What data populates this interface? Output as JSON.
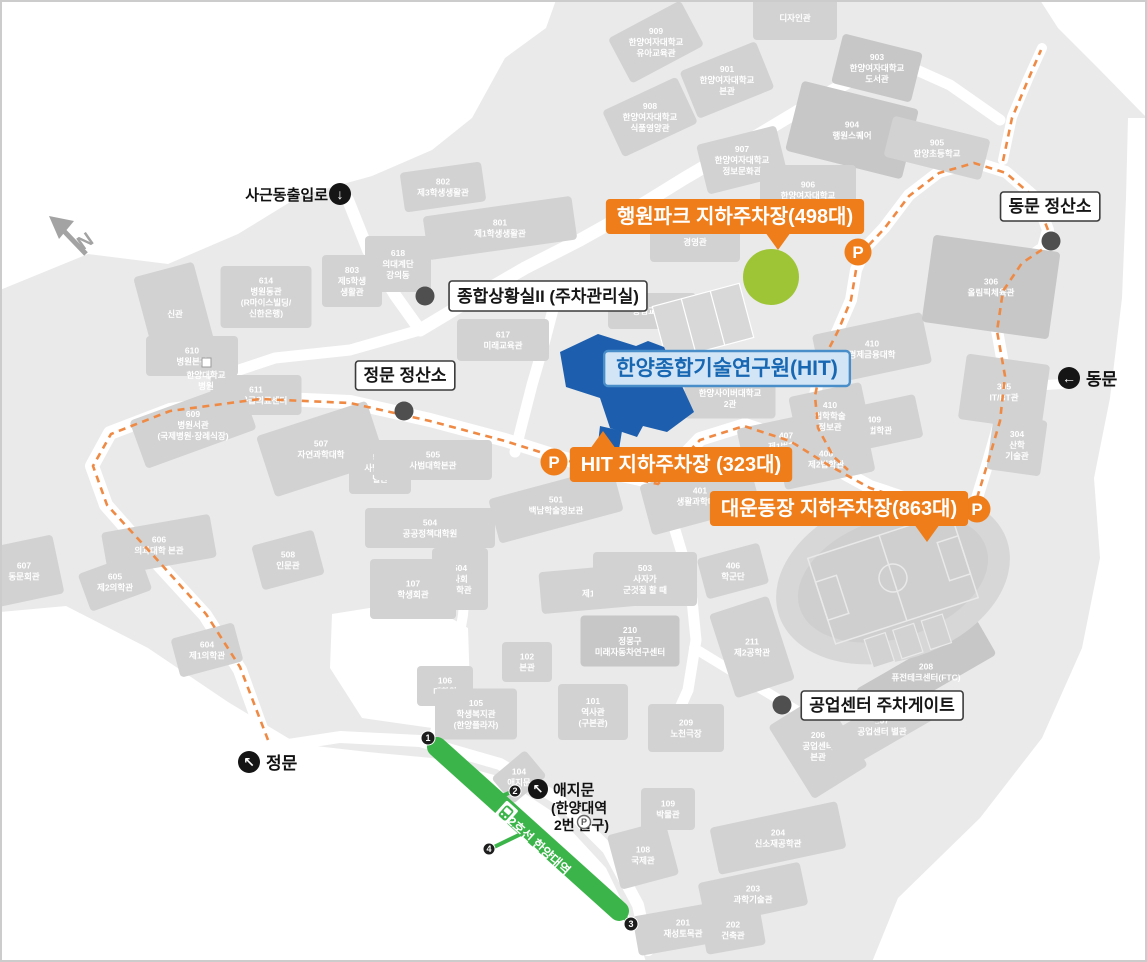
{
  "colors": {
    "accent_orange": "#ef7d1a",
    "route_orange": "#ef8a45",
    "hit_blue": "#1d5fae",
    "hit_label_bg": "#d2e5f6",
    "hit_label_border": "#4a8ec9",
    "hit_label_text": "#1767b3",
    "subway_green": "#3bb54a",
    "park_green": "#9ec535",
    "dot_gray": "#4f4f4f",
    "building_gray": "#d2d2d2",
    "terrain_gray": "#eaeaea"
  },
  "compass_label": "N",
  "p_letter": "P",
  "parking_callouts": [
    {
      "label": "행원파크 지하주차장(498대)",
      "cx": 735,
      "cy": 216,
      "tail": "down",
      "tail_x": 778
    },
    {
      "label": "HIT 지하주차장 (323대)",
      "cx": 681,
      "cy": 464,
      "tail": "up",
      "tail_x": 603
    },
    {
      "label": "대운동장 지하주차장(863대)",
      "cx": 839,
      "cy": 508,
      "tail": "down",
      "tail_x": 927
    }
  ],
  "p_markers": [
    {
      "x": 858,
      "y": 252
    },
    {
      "x": 554,
      "y": 462
    },
    {
      "x": 977,
      "y": 509
    }
  ],
  "info_callouts": [
    {
      "label": "동문 정산소",
      "cx": 1050,
      "cy": 206,
      "dot_x": 1051,
      "dot_y": 241
    },
    {
      "label": "정문 정산소",
      "cx": 405,
      "cy": 375,
      "dot_x": 404,
      "dot_y": 411
    },
    {
      "label": "종합상황실II (주차관리실)",
      "cx": 548,
      "cy": 296,
      "dot_x": 425,
      "dot_y": 296
    },
    {
      "label": "공업센터 주차게이트",
      "cx": 882,
      "cy": 705,
      "dot_x": 782,
      "dot_y": 705
    }
  ],
  "hit_callout": {
    "label": "한양종합기술연구원(HIT)",
    "cx": 727,
    "cy": 368
  },
  "gates": [
    {
      "label": "사근동출입로",
      "arrow": "↓",
      "icon_x": 340,
      "icon_y": 194,
      "text_x": 328,
      "text_y": 200,
      "anchor": "end",
      "size": 15
    },
    {
      "label": "동문",
      "arrow": "←",
      "icon_x": 1069,
      "icon_y": 378,
      "text_x": 1086,
      "text_y": 385,
      "anchor": "start",
      "size": 17
    },
    {
      "label": "정문",
      "arrow": "↖",
      "icon_x": 249,
      "icon_y": 762,
      "text_x": 266,
      "text_y": 769,
      "anchor": "start",
      "size": 17
    }
  ],
  "ajimun": {
    "label": "애지문",
    "sub1": "(한양대역",
    "sub2": "2번 출구)",
    "arrow": "↖",
    "icon_x": 538,
    "icon_y": 789,
    "p_x": 584,
    "p_y": 822
  },
  "subway": {
    "line_label": "2호선 한양대역",
    "exits": [
      {
        "n": "1",
        "x": 428,
        "y": 738
      },
      {
        "n": "2",
        "x": 515,
        "y": 791
      },
      {
        "n": "3",
        "x": 631,
        "y": 924
      },
      {
        "n": "4",
        "x": 489,
        "y": 849
      }
    ]
  },
  "stadium": {
    "num": "301",
    "name": "대운동장",
    "x": 893,
    "y": 568
  },
  "hwangwon": {
    "num": "707",
    "name": "행원파크",
    "x": 771,
    "y": 276
  },
  "tennis": {
    "name": "테니스장",
    "x": 710,
    "y": 337
  },
  "hospital_sub": {
    "line1": "한양대학교",
    "line2": "병원",
    "x": 206,
    "y": 384
  },
  "buildings": [
    {
      "l": [
        "909",
        "한양여자대학교",
        "유아교육관"
      ],
      "x": 656,
      "y": 42,
      "r": -28
    },
    {
      "l": [
        "901",
        "한양여자대학교",
        "본관"
      ],
      "x": 727,
      "y": 80,
      "r": -22
    },
    {
      "l": [
        "903",
        "한양여자대학교",
        "도서관"
      ],
      "x": 877,
      "y": 68,
      "r": 14,
      "f": 1
    },
    {
      "l": [
        "908",
        "한양여자대학교",
        "식품영양관"
      ],
      "x": 650,
      "y": 117,
      "r": -25
    },
    {
      "l": [
        "904",
        "행원스퀘어"
      ],
      "x": 852,
      "y": 130,
      "r": 14,
      "w": 120,
      "h": 72,
      "f": 1
    },
    {
      "l": [
        "907",
        "한양여자대학교",
        "정보문화관"
      ],
      "x": 742,
      "y": 160,
      "r": -14
    },
    {
      "l": [
        "905",
        "한양초등학교"
      ],
      "x": 937,
      "y": 148,
      "r": 14,
      "w": 100,
      "h": 42
    },
    {
      "l": [
        "906",
        "한양여자대학교"
      ],
      "x": 808,
      "y": 190,
      "r": 0,
      "w": 96,
      "h": 50
    },
    {
      "l": [
        "디자인관"
      ],
      "x": 795,
      "y": 18,
      "r": 0,
      "w": 84,
      "h": 44
    },
    {
      "l": [
        "802",
        "제3학생생활관"
      ],
      "x": 443,
      "y": 187,
      "r": -8
    },
    {
      "l": [
        "801",
        "제1학생생활관"
      ],
      "x": 500,
      "y": 228,
      "r": -8,
      "w": 150,
      "h": 44
    },
    {
      "l": [
        "618",
        "의대계단",
        "강의동"
      ],
      "x": 398,
      "y": 264,
      "r": 0,
      "w": 66,
      "h": 56
    },
    {
      "l": [
        "803",
        "제5학생",
        "생활관"
      ],
      "x": 352,
      "y": 281,
      "r": 0,
      "w": 60,
      "h": 52
    },
    {
      "l": [
        "614",
        "병원동관",
        "(R마이스빌딩/",
        "신한은행)"
      ],
      "x": 266,
      "y": 297,
      "r": 0
    },
    {
      "l": [
        "신관"
      ],
      "x": 175,
      "y": 314,
      "r": -15,
      "w": 62,
      "h": 92
    },
    {
      "l": [
        "610",
        "병원본관"
      ],
      "x": 192,
      "y": 356,
      "r": 0,
      "w": 92,
      "h": 40
    },
    {
      "l": [
        "611",
        "권역응급의료센터"
      ],
      "x": 256,
      "y": 395,
      "r": 0
    },
    {
      "l": [
        "609",
        "병원서관",
        "(국제병원·장례식장)"
      ],
      "x": 193,
      "y": 425,
      "r": -20
    },
    {
      "l": [
        "607",
        "동문회관"
      ],
      "x": 24,
      "y": 571,
      "r": -12,
      "w": 70,
      "h": 60
    },
    {
      "l": [
        "606",
        "의과대학 본관"
      ],
      "x": 159,
      "y": 545,
      "r": -10,
      "w": 110,
      "h": 44
    },
    {
      "l": [
        "605",
        "제2의학관"
      ],
      "x": 115,
      "y": 582,
      "r": -20
    },
    {
      "l": [
        "604",
        "제1의학관"
      ],
      "x": 207,
      "y": 650,
      "r": -15
    },
    {
      "l": [
        "508",
        "인문관"
      ],
      "x": 288,
      "y": 560,
      "r": -15,
      "w": 64,
      "h": 46
    },
    {
      "l": [
        "507",
        "자연과학대학"
      ],
      "x": 321,
      "y": 449,
      "r": -18,
      "w": 116,
      "h": 64
    },
    {
      "l": [
        "506",
        "사범대학",
        "별관"
      ],
      "x": 380,
      "y": 468,
      "r": 0,
      "w": 62,
      "h": 52
    },
    {
      "l": [
        "505",
        "사범대학본관"
      ],
      "x": 433,
      "y": 460,
      "r": 0,
      "w": 118,
      "h": 40
    },
    {
      "l": [
        "501",
        "백남학술정보관"
      ],
      "x": 556,
      "y": 505,
      "r": -15,
      "w": 128,
      "h": 46
    },
    {
      "l": [
        "504",
        "공공정책대학원"
      ],
      "x": 430,
      "y": 528,
      "r": 0,
      "w": 130,
      "h": 40
    },
    {
      "l": [
        "504",
        "사회",
        "과학관"
      ],
      "x": 460,
      "y": 579,
      "r": 0,
      "w": 56,
      "h": 62
    },
    {
      "l": [
        "107",
        "학생회관"
      ],
      "x": 413,
      "y": 589,
      "r": 0,
      "w": 86,
      "h": 60
    },
    {
      "l": [
        "212",
        "제1공학관"
      ],
      "x": 600,
      "y": 588,
      "r": -5,
      "w": 120,
      "h": 42
    },
    {
      "l": [
        "503",
        "사자가",
        "군것질 할 때"
      ],
      "x": 645,
      "y": 579,
      "r": 0,
      "w": 104,
      "h": 54
    },
    {
      "l": [
        "102",
        "본관"
      ],
      "x": 527,
      "y": 662,
      "r": 0,
      "w": 50,
      "h": 40
    },
    {
      "l": [
        "106",
        "대학원"
      ],
      "x": 445,
      "y": 686,
      "r": 0,
      "w": 56,
      "h": 40
    },
    {
      "l": [
        "105",
        "학생복지관",
        "(한양플라자)"
      ],
      "x": 476,
      "y": 714,
      "r": 0
    },
    {
      "l": [
        "101",
        "역사관",
        "(구본관)"
      ],
      "x": 593,
      "y": 712,
      "r": 0,
      "w": 70,
      "h": 56
    },
    {
      "l": [
        "104",
        "애지문"
      ],
      "x": 519,
      "y": 777,
      "r": -40,
      "w": 44,
      "h": 34
    },
    {
      "l": [
        "108",
        "국제관"
      ],
      "x": 643,
      "y": 855,
      "r": -15,
      "w": 60,
      "h": 56
    },
    {
      "l": [
        "109",
        "박물관"
      ],
      "x": 668,
      "y": 809,
      "r": 0,
      "w": 54,
      "h": 42
    },
    {
      "l": [
        "201",
        "재성토목관"
      ],
      "x": 683,
      "y": 928,
      "r": -10,
      "w": 96,
      "h": 40
    },
    {
      "l": [
        "202",
        "건축관"
      ],
      "x": 733,
      "y": 930,
      "r": -10,
      "w": 60,
      "h": 40
    },
    {
      "l": [
        "203",
        "과학기술관"
      ],
      "x": 753,
      "y": 894,
      "r": -12,
      "w": 104,
      "h": 44
    },
    {
      "l": [
        "204",
        "신소재공학관"
      ],
      "x": 778,
      "y": 838,
      "r": -12,
      "w": 130,
      "h": 48
    },
    {
      "l": [
        "209",
        "노천극장"
      ],
      "x": 686,
      "y": 728,
      "r": 0,
      "w": 76,
      "h": 48
    },
    {
      "l": [
        "206",
        "공업센터",
        "본관"
      ],
      "x": 818,
      "y": 746,
      "r": -32,
      "w": 64,
      "h": 86
    },
    {
      "l": [
        "207",
        "공업센터 별관"
      ],
      "x": 882,
      "y": 726,
      "r": -30,
      "w": 110,
      "h": 40
    },
    {
      "l": [
        "208",
        "퓨전테크센터(FTC)"
      ],
      "x": 926,
      "y": 672,
      "r": -30,
      "w": 140,
      "h": 40,
      "f": 1
    },
    {
      "l": [
        "211",
        "제2공학관"
      ],
      "x": 752,
      "y": 647,
      "r": -18,
      "w": 62,
      "h": 88
    },
    {
      "l": [
        "210",
        "정몽구",
        "미래자동차연구센터"
      ],
      "x": 630,
      "y": 641,
      "r": 0,
      "f": 1
    },
    {
      "l": [
        "406",
        "학군단"
      ],
      "x": 733,
      "y": 571,
      "r": -15,
      "w": 64,
      "h": 42
    },
    {
      "l": [
        "401",
        "생활과학대학"
      ],
      "x": 700,
      "y": 496,
      "r": -15,
      "w": 112,
      "h": 52
    },
    {
      "l": [
        "407",
        "제1법학관"
      ],
      "x": 786,
      "y": 441,
      "r": -12,
      "w": 92,
      "h": 44
    },
    {
      "l": [
        "408",
        "제2법학관"
      ],
      "x": 826,
      "y": 459,
      "r": -12,
      "w": 92,
      "h": 44
    },
    {
      "l": [
        "409",
        "제3법학관"
      ],
      "x": 874,
      "y": 425,
      "r": -12,
      "w": 92,
      "h": 44
    },
    {
      "l": [
        "410",
        "경제금융대학"
      ],
      "x": 872,
      "y": 349,
      "r": -12,
      "w": 112,
      "h": 52
    },
    {
      "l": [
        "410",
        "법학학술",
        "정보관"
      ],
      "x": 830,
      "y": 416,
      "r": -12,
      "w": 74,
      "h": 54
    },
    {
      "l": [
        "305",
        "IT/BT관"
      ],
      "x": 1004,
      "y": 392,
      "r": 8,
      "w": 84,
      "h": 66
    },
    {
      "l": [
        "304",
        "산학",
        "기술관"
      ],
      "x": 1017,
      "y": 445,
      "r": 8,
      "w": 54,
      "h": 56
    },
    {
      "l": [
        "306",
        "올림픽체육관"
      ],
      "x": 991,
      "y": 287,
      "r": 8,
      "w": 128,
      "h": 88,
      "f": 1
    },
    {
      "l": [
        "617",
        "미래교육관"
      ],
      "x": 503,
      "y": 340,
      "r": 0,
      "w": 92,
      "h": 42
    },
    {
      "l": [
        "봉림교육관"
      ],
      "x": 652,
      "y": 311,
      "r": 0,
      "w": 88,
      "h": 36
    },
    {
      "l": [
        "703",
        "한양사이버대학교",
        "2관"
      ],
      "x": 730,
      "y": 393,
      "r": 0
    },
    {
      "l": [
        "경영관"
      ],
      "x": 695,
      "y": 242,
      "r": 0,
      "w": 90,
      "h": 40
    }
  ]
}
